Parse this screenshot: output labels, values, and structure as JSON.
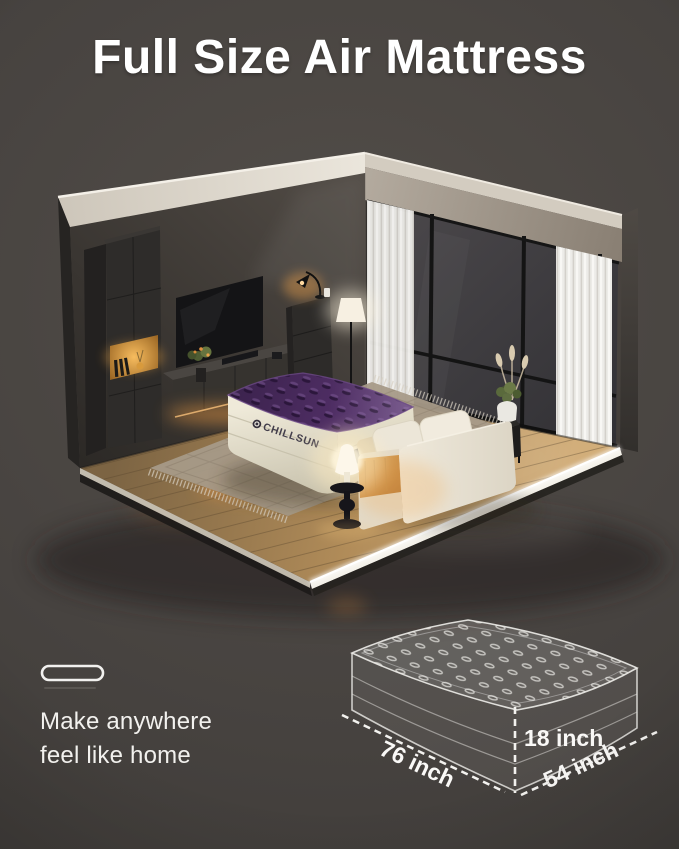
{
  "header": {
    "title": "Full Size Air Mattress"
  },
  "scene": {
    "brand_label": "CHILLSUN"
  },
  "footer": {
    "tagline_line1": "Make anywhere",
    "tagline_line2": "feel like home"
  },
  "diagram": {
    "length_label": "76 inch",
    "height_label": "18 inch",
    "width_label": "54 inch"
  },
  "colors": {
    "page_background": "#47433f",
    "title_text": "#ffffff",
    "annotation_text": "#faf9f7",
    "brand_text": "#433e4b",
    "mattress_top_purple": "#4c2b60",
    "mattress_base_cream": "#e9e4d2",
    "sofa_cream": "#e9e3d6",
    "floor_wood": "#c2a06c",
    "wall_gray": "#413d39",
    "ceiling_beam": "#d9d3c9",
    "curtain_white": "#eceae5",
    "window_frame": "#161616",
    "rug_tan": "#a79a88",
    "warm_glow": "#f2a648"
  }
}
